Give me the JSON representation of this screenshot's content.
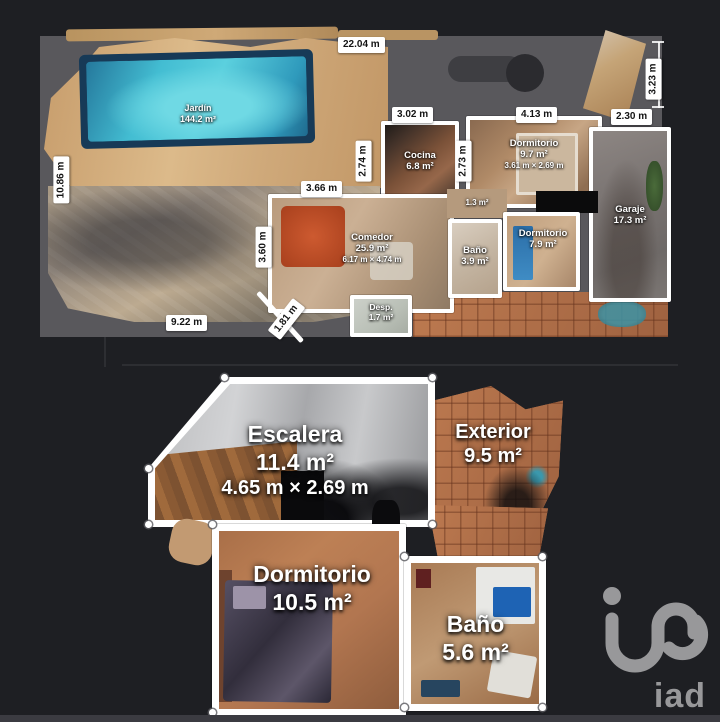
{
  "colors": {
    "page_bg": "#1e1f23",
    "panel_bg": "#59585c",
    "pool_water": "#43bdd2",
    "terracotta": "#b06e47",
    "wall_white": "#ffffff",
    "logo_gray": "#98989a"
  },
  "floor1": {
    "rooms": {
      "jardin": {
        "name": "Jardín",
        "area": "144.2 m²"
      },
      "cocina": {
        "name": "Cocina",
        "area": "6.8 m²"
      },
      "dormitorio_1": {
        "name": "Dormitorio",
        "area": "9.7 m²",
        "dims": "3.61 m × 2.69 m"
      },
      "garaje": {
        "name": "Garaje",
        "area": "17.3 m²"
      },
      "comedor": {
        "name": "Comedor",
        "area": "25.9 m²",
        "dims": "6.17 m × 4.74 m"
      },
      "pasillo": {
        "area": "1.3 m²"
      },
      "bano": {
        "name": "Baño",
        "area": "3.9 m²"
      },
      "dormitorio_2": {
        "name": "Dormitorio",
        "area": "7.9 m²"
      },
      "despensa": {
        "name": "Desp.",
        "area": "1.7 m²"
      }
    },
    "dims": {
      "width_total": "22.04 m",
      "height_left": "10.86 m",
      "height_right": "3.23 m",
      "cocina_width": "3.02 m",
      "dorm_width": "4.13 m",
      "garaje_width": "2.30 m",
      "cocina_height": "2.74 m",
      "dorm_height": "2.73 m",
      "comedor_width": "3.66 m",
      "comedor_height": "3.60 m",
      "patio_width": "9.22 m",
      "wall_diagonal": "1.81 m"
    }
  },
  "floor2": {
    "rooms": {
      "escalera": {
        "name": "Escalera",
        "area": "11.4 m²",
        "dims": "4.65 m × 2.69 m"
      },
      "exterior": {
        "name": "Exterior",
        "area": "9.5 m²"
      },
      "dormitorio": {
        "name": "Dormitorio",
        "area": "10.5 m²"
      },
      "bano": {
        "name": "Baño",
        "area": "5.6 m²"
      }
    }
  },
  "branding": {
    "logo_text": "iad"
  }
}
